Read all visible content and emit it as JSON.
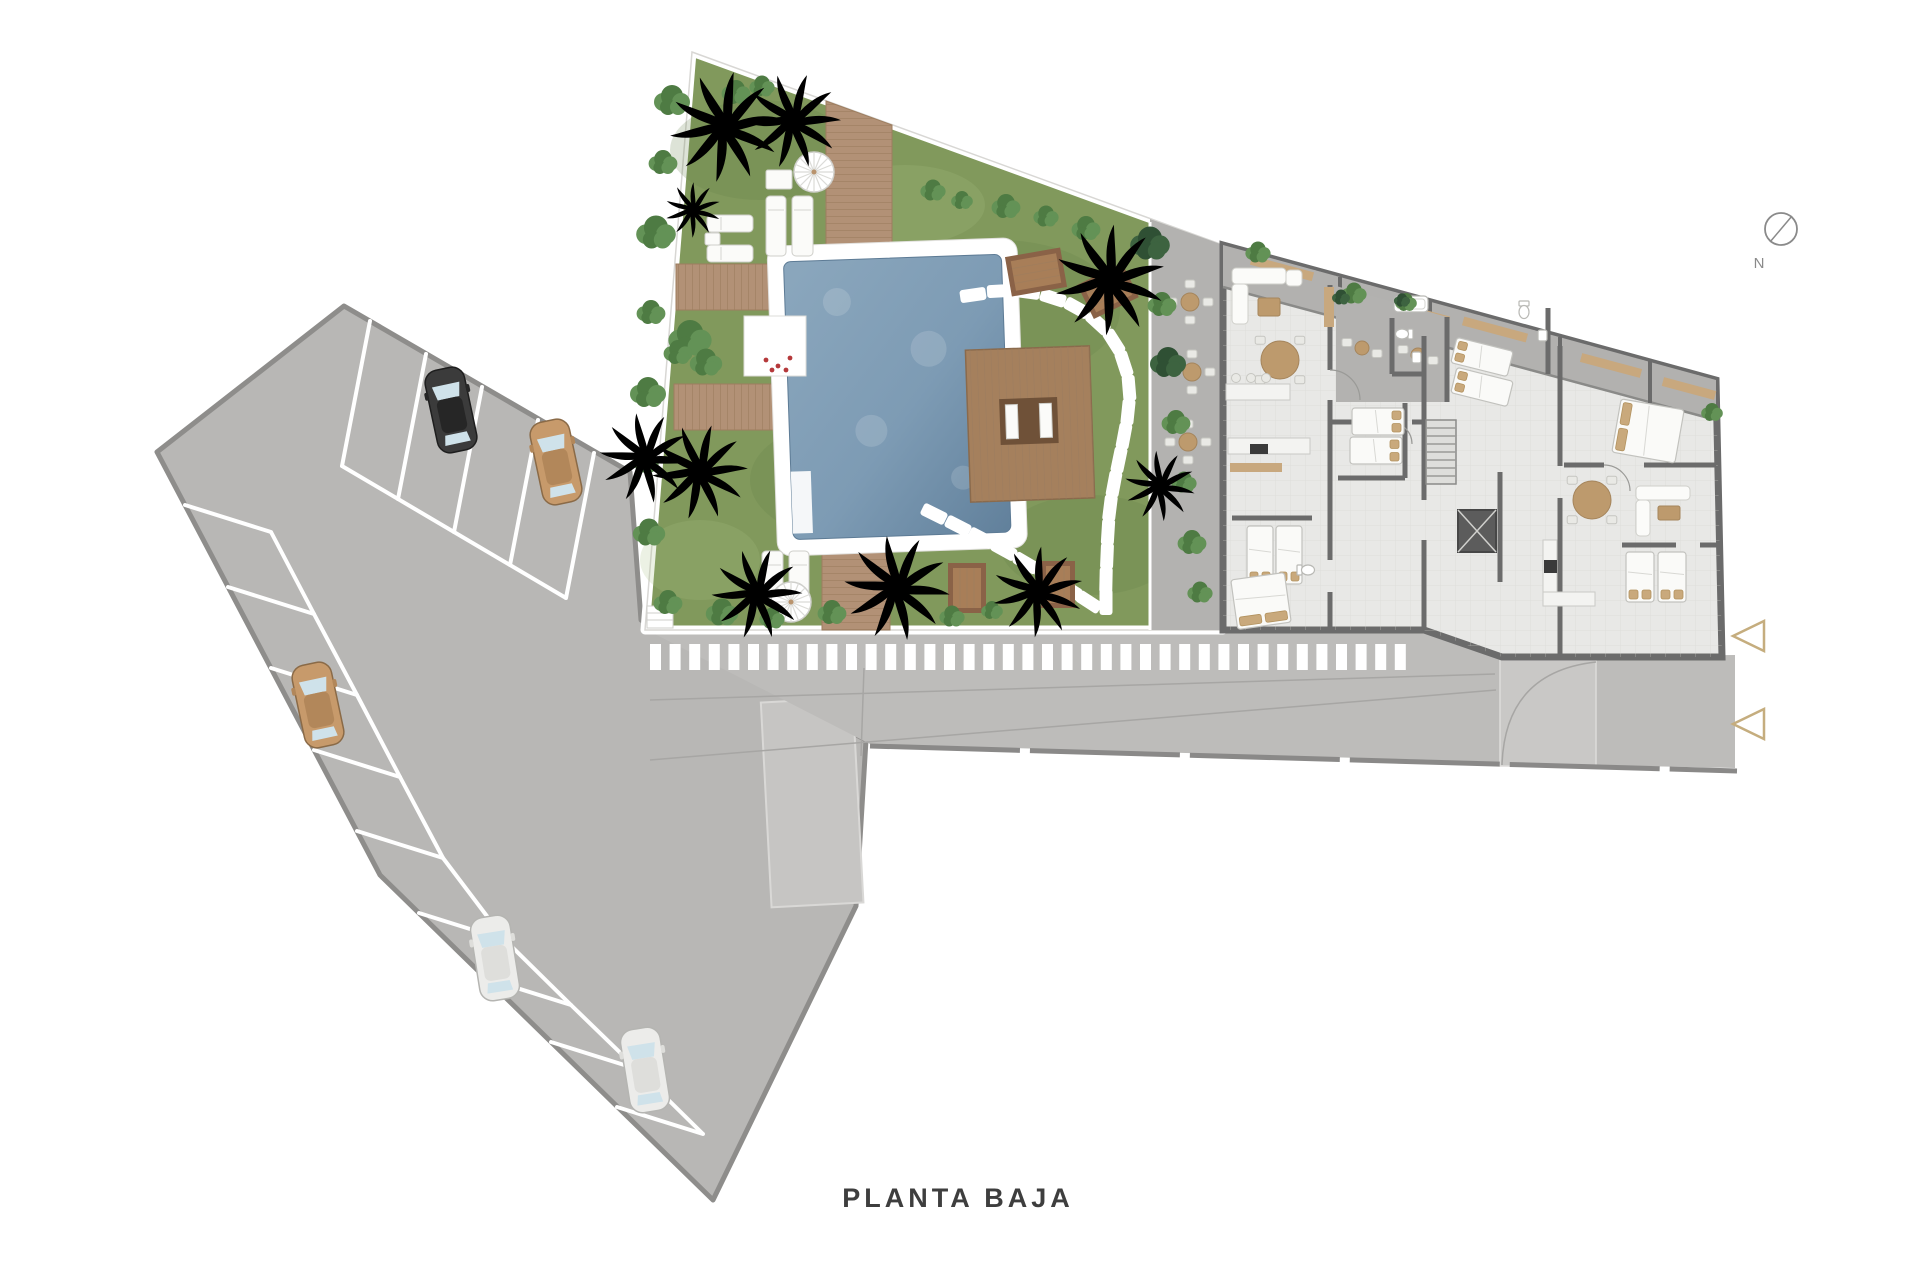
{
  "labels": {
    "title": "PLANTA BAJA",
    "north": "N"
  },
  "palette": {
    "grass": "#81995c",
    "water": "#7d9bb4",
    "lot": "#b8b7b5",
    "road": "#bdbcba",
    "wall": "#6b6b6b",
    "floor": "#e8e8e6",
    "terrace": "#b3b2b0",
    "deck": "#b29176",
    "accent_tan": "#c5ad7e",
    "stone_white": "#ffffff",
    "title_color": "#3e3e3e"
  },
  "compass": {
    "cx": 1781,
    "cy": 229,
    "r": 16
  },
  "arrows": [
    {
      "x": 1733,
      "y": 636
    },
    {
      "x": 1733,
      "y": 724
    }
  ],
  "parking": {
    "top_stalls": {
      "starts": [
        [
          370,
          321
        ],
        [
          426,
          354
        ],
        [
          482,
          387
        ],
        [
          538,
          420
        ],
        [
          594,
          453
        ]
      ],
      "vec": [
        -28,
        145
      ]
    },
    "bottom_stalls": {
      "starts": [
        [
          185,
          505
        ],
        [
          228,
          587
        ],
        [
          271,
          668
        ],
        [
          314,
          750
        ],
        [
          357,
          831
        ],
        [
          419,
          913
        ],
        [
          485,
          978
        ],
        [
          551,
          1042
        ],
        [
          617,
          1107
        ]
      ],
      "vec": [
        86,
        27
      ]
    },
    "aisles": [
      [
        [
          342,
          466
        ],
        [
          566,
          598
        ]
      ],
      [
        [
          271,
          532
        ],
        [
          314,
          614
        ],
        [
          357,
          695
        ],
        [
          400,
          777
        ],
        [
          443,
          858
        ],
        [
          505,
          940
        ],
        [
          571,
          1005
        ],
        [
          637,
          1069
        ],
        [
          703,
          1134
        ]
      ]
    ],
    "cars": [
      {
        "color": "dark",
        "x": 451,
        "y": 410,
        "rot": -12
      },
      {
        "color": "tan",
        "x": 556,
        "y": 462,
        "rot": -12
      },
      {
        "color": "tan",
        "x": 318,
        "y": 705,
        "rot": -12
      },
      {
        "color": "white",
        "x": 495,
        "y": 958,
        "rot": -9
      },
      {
        "color": "white",
        "x": 645,
        "y": 1070,
        "rot": -9
      }
    ],
    "car_colors": {
      "dark": {
        "body": "#3b3b3b",
        "roof": "#262626",
        "line": "#1e1e1e"
      },
      "tan": {
        "body": "#c79a6b",
        "roof": "#b2875a",
        "line": "#8a6a47"
      },
      "white": {
        "body": "#ececea",
        "roof": "#dededb",
        "line": "#b5b5b2"
      }
    }
  },
  "crosswalk": {
    "x1": 650,
    "y": 644,
    "w": 11,
    "h": 26,
    "step": 19.6,
    "count": 39
  },
  "road_lines": [
    [
      650,
      700,
      1495,
      674
    ],
    [
      650,
      760,
      1496,
      690
    ],
    [
      864,
      668,
      861,
      756
    ]
  ],
  "garden": {
    "palms": [
      [
        725,
        127,
        1.1,
        "A"
      ],
      [
        793,
        121,
        0.95,
        "B"
      ],
      [
        693,
        210,
        0.55,
        "B"
      ],
      [
        700,
        472,
        0.95,
        "A"
      ],
      [
        757,
        594,
        0.9,
        "B"
      ],
      [
        897,
        588,
        1.05,
        "A"
      ],
      [
        1038,
        592,
        0.9,
        "B"
      ],
      [
        1110,
        280,
        1.1,
        "A"
      ],
      [
        1160,
        486,
        0.7,
        "B"
      ],
      [
        645,
        458,
        0.9,
        "S"
      ]
    ],
    "bushes": [
      [
        672,
        100,
        1,
        "g"
      ],
      [
        663,
        162,
        0.8,
        "g"
      ],
      [
        656,
        232,
        1.1,
        "g"
      ],
      [
        651,
        312,
        0.8,
        "g"
      ],
      [
        648,
        392,
        1,
        "g"
      ],
      [
        646,
        462,
        0.7,
        "g"
      ],
      [
        649,
        532,
        0.9,
        "g"
      ],
      [
        668,
        602,
        0.8,
        "g"
      ],
      [
        722,
        612,
        0.9,
        "g"
      ],
      [
        772,
        618,
        0.7,
        "g"
      ],
      [
        832,
        612,
        0.8,
        "g"
      ],
      [
        952,
        616,
        0.7,
        "g"
      ],
      [
        992,
        610,
        0.6,
        "g"
      ],
      [
        1006,
        206,
        0.8,
        "g"
      ],
      [
        1046,
        216,
        0.7,
        "g"
      ],
      [
        1086,
        228,
        0.8,
        "g"
      ],
      [
        1150,
        243,
        1.1,
        "d"
      ],
      [
        1162,
        304,
        0.8,
        "g"
      ],
      [
        1168,
        362,
        1,
        "d"
      ],
      [
        1176,
        422,
        0.8,
        "g"
      ],
      [
        1184,
        482,
        0.7,
        "g"
      ],
      [
        1192,
        542,
        0.8,
        "g"
      ],
      [
        1200,
        592,
        0.7,
        "g"
      ],
      [
        736,
        92,
        0.8,
        "g"
      ],
      [
        762,
        86,
        0.7,
        "g"
      ],
      [
        690,
        338,
        1.2,
        "g"
      ],
      [
        706,
        362,
        0.9,
        "g"
      ],
      [
        678,
        352,
        0.8,
        "g"
      ],
      [
        933,
        190,
        0.7,
        "g"
      ],
      [
        962,
        200,
        0.6,
        "g"
      ],
      [
        1258,
        252,
        0.7,
        "g"
      ],
      [
        1354,
        293,
        0.7,
        "g"
      ],
      [
        1406,
        302,
        0.6,
        "g"
      ],
      [
        1712,
        412,
        0.6,
        "g"
      ],
      [
        1341,
        297,
        0.5,
        "d"
      ],
      [
        1402,
        300,
        0.45,
        "d"
      ]
    ],
    "stones": [
      [
        [
          973,
          295
        ],
        [
          1000,
          291
        ],
        [
          1027,
          292
        ],
        [
          1053,
          298
        ],
        [
          1077,
          308
        ],
        [
          1098,
          323
        ],
        [
          1114,
          342
        ],
        [
          1124,
          364
        ],
        [
          1129,
          388
        ],
        [
          1128,
          412
        ],
        [
          1124,
          436
        ],
        [
          1119,
          460
        ],
        [
          1114,
          484
        ],
        [
          1110,
          508
        ],
        [
          1108,
          532
        ],
        [
          1107,
          556
        ],
        [
          1106,
          580
        ],
        [
          1106,
          602
        ]
      ],
      [
        [
          934,
          514
        ],
        [
          958,
          526
        ],
        [
          981,
          538
        ],
        [
          1004,
          550
        ],
        [
          1026,
          563
        ],
        [
          1048,
          576
        ],
        [
          1069,
          589
        ],
        [
          1089,
          602
        ]
      ]
    ],
    "loungers": [
      [
        766,
        196,
        20,
        60
      ],
      [
        792,
        196,
        21,
        60
      ],
      [
        707,
        215,
        46,
        17
      ],
      [
        707,
        245,
        46,
        17
      ],
      [
        762,
        551,
        21,
        50
      ],
      [
        789,
        551,
        20,
        50
      ]
    ],
    "side_tables": [
      [
        766,
        170,
        26,
        19
      ],
      [
        705,
        233,
        15,
        12
      ]
    ],
    "umbrellas": [
      [
        814,
        172
      ],
      [
        791,
        602
      ]
    ],
    "picnic_tables": [
      [
        1008,
        252,
        56,
        40,
        -10
      ],
      [
        1083,
        272,
        50,
        38,
        -26
      ],
      [
        948,
        563,
        38,
        50,
        0
      ],
      [
        1041,
        561,
        34,
        47,
        0
      ]
    ],
    "planter_flowers": [
      [
        766,
        360
      ],
      [
        778,
        366
      ],
      [
        790,
        358
      ],
      [
        772,
        370
      ],
      [
        786,
        370
      ]
    ]
  },
  "terrace": {
    "tablesets": [
      [
        1190,
        302
      ],
      [
        1192,
        372
      ],
      [
        1188,
        442
      ]
    ],
    "bistro": [
      [
        1362,
        348
      ],
      [
        1418,
        355
      ]
    ]
  },
  "building": {
    "louvers": [
      [
        1250,
        264,
        64
      ],
      [
        1392,
        309,
        58
      ],
      [
        1462,
        325,
        66
      ],
      [
        1580,
        361,
        62
      ],
      [
        1662,
        384,
        54
      ]
    ],
    "beds": [
      {
        "x": 1247,
        "y": 526,
        "w": 26,
        "h": 58,
        "rot": 0,
        "p": "bottom"
      },
      {
        "x": 1276,
        "y": 526,
        "w": 26,
        "h": 58,
        "rot": 0,
        "p": "bottom"
      },
      {
        "x": 1234,
        "y": 576,
        "w": 54,
        "h": 50,
        "rot": -8,
        "p": "bottom"
      },
      {
        "x": 1352,
        "y": 408,
        "w": 52,
        "h": 27,
        "rot": 0,
        "p": "right"
      },
      {
        "x": 1350,
        "y": 437,
        "w": 52,
        "h": 27,
        "rot": 0,
        "p": "right"
      },
      {
        "x": 1453,
        "y": 344,
        "w": 58,
        "h": 26,
        "rot": 14,
        "p": "left"
      },
      {
        "x": 1453,
        "y": 374,
        "w": 58,
        "h": 26,
        "rot": 14,
        "p": "left"
      },
      {
        "x": 1616,
        "y": 404,
        "w": 64,
        "h": 54,
        "rot": 10,
        "p": "left"
      },
      {
        "x": 1626,
        "y": 552,
        "w": 28,
        "h": 50,
        "rot": 0,
        "p": "bottom"
      },
      {
        "x": 1658,
        "y": 552,
        "w": 28,
        "h": 50,
        "rot": 0,
        "p": "bottom"
      }
    ],
    "round_tables": [
      {
        "x": 1280,
        "y": 360,
        "r": 19
      },
      {
        "x": 1592,
        "y": 500,
        "r": 19
      }
    ],
    "sofas": [
      [
        1232,
        268,
        54,
        16
      ],
      [
        1232,
        284,
        16,
        40
      ],
      [
        1286,
        270,
        16,
        16
      ],
      [
        1636,
        486,
        54,
        14
      ],
      [
        1636,
        500,
        14,
        36
      ]
    ],
    "coffee_tables": [
      [
        1258,
        298,
        22,
        18
      ],
      [
        1658,
        506,
        22,
        14
      ]
    ],
    "kitchen_counters": [
      [
        1226,
        384,
        64,
        16
      ],
      [
        1228,
        438,
        82,
        16
      ],
      [
        1543,
        540,
        14,
        60
      ],
      [
        1543,
        592,
        52,
        14
      ]
    ],
    "appliances": [
      [
        1250,
        444,
        18,
        10
      ],
      [
        1544,
        560,
        13,
        13
      ]
    ],
    "stools": [
      [
        1236,
        378
      ],
      [
        1251,
        378
      ],
      [
        1266,
        378
      ]
    ],
    "wood_mats": [
      [
        1230,
        463,
        52,
        9
      ],
      [
        1324,
        287,
        10,
        40
      ]
    ],
    "toilets": [
      {
        "x": 1404,
        "y": 334,
        "rot": 90
      },
      {
        "x": 1524,
        "y": 310,
        "rot": 0
      },
      {
        "x": 1306,
        "y": 570,
        "rot": -90
      }
    ],
    "sinks": [
      [
        1412,
        352,
        9,
        11
      ],
      [
        1538,
        330,
        9,
        11
      ]
    ],
    "tubs": [
      [
        1394,
        296,
        34,
        16
      ]
    ],
    "stairs": {
      "x": 1426,
      "y": 420,
      "w": 30,
      "h": 64,
      "steps": 7
    },
    "elevator": {
      "x": 1458,
      "y": 510,
      "w": 38,
      "h": 42
    }
  }
}
